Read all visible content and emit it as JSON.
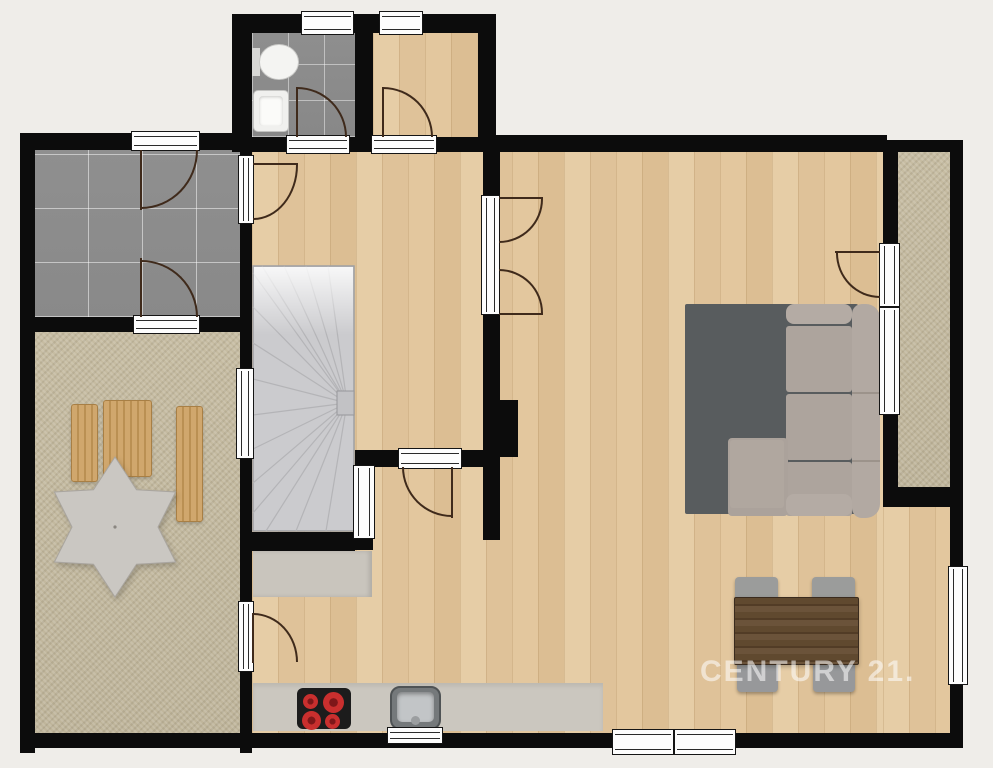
{
  "watermark": {
    "text": "CENTURY 21."
  },
  "canvas": {
    "width": 993,
    "height": 768,
    "background": "#efede9"
  },
  "palette": {
    "wall": "#0c0c0c",
    "wood_floor": "#e2c79f",
    "tile_floor": "#8e8e8e",
    "terrace_floor": "#c4ba9f",
    "stair": "#cbcbce",
    "rug": "#585c5e",
    "sofa": "#ada49d",
    "table_wood": "#5d4833",
    "counter": "#cbc7bf",
    "burner_red": "#c92f2e",
    "door_swing": "#3f2a1b",
    "window_white": "#fdfdfd",
    "watermark_white": "#ffffff"
  },
  "elements": [
    {
      "n": "living-area-floor",
      "c": "f-wood",
      "x": 252,
      "y": 150,
      "w": 631,
      "h": 583
    },
    {
      "n": "living-area-floor-east",
      "c": "f-wood",
      "x": 883,
      "y": 507,
      "w": 69,
      "h": 226
    },
    {
      "n": "small-room-floor",
      "c": "f-wood",
      "x": 373,
      "y": 33,
      "w": 105,
      "h": 104
    },
    {
      "n": "bathroom-floor",
      "c": "f-tile-sm",
      "x": 252,
      "y": 33,
      "w": 103,
      "h": 104
    },
    {
      "n": "entry-floor",
      "c": "f-tile-lg",
      "x": 34,
      "y": 150,
      "w": 206,
      "h": 167
    },
    {
      "n": "terrace-floor",
      "c": "f-terrace",
      "x": 35,
      "y": 332,
      "w": 205,
      "h": 408
    },
    {
      "n": "balcony-floor",
      "c": "f-terrace",
      "x": 898,
      "y": 150,
      "w": 52,
      "h": 337
    },
    {
      "n": "kitchen-cabinet",
      "x": 253,
      "y": 551,
      "w": 119,
      "h": 46,
      "bg": "#c9c5bd",
      "sh": "inset -3px 0 4px rgba(0,0,0,.12)"
    },
    {
      "n": "kitchen-counter",
      "x": 253,
      "y": 683,
      "w": 350,
      "h": 48,
      "bg": "#cbc7bf",
      "sh": "inset 0 3px 4px rgba(0,0,0,.08)"
    },
    {
      "n": "cooktop",
      "x": 297,
      "y": 688,
      "w": 54,
      "h": 41,
      "bg": "#1c1c1c",
      "br": "6px"
    },
    {
      "n": "burner",
      "c": "burner",
      "x": 303,
      "y": 694,
      "w": 15,
      "h": 15
    },
    {
      "n": "burner",
      "c": "burner",
      "x": 323,
      "y": 692,
      "w": 21,
      "h": 21
    },
    {
      "n": "burner",
      "c": "burner",
      "x": 302,
      "y": 711,
      "w": 19,
      "h": 19
    },
    {
      "n": "burner",
      "c": "burner",
      "x": 325,
      "y": 714,
      "w": 15,
      "h": 15
    },
    {
      "n": "kitchen-sink",
      "x": 390,
      "y": 686,
      "w": 51,
      "h": 44,
      "bg": "#75797b",
      "br": "10px",
      "bd": "2px solid #4f5355"
    },
    {
      "n": "kitchen-sink-basin",
      "x": 397,
      "y": 692,
      "w": 37,
      "h": 30,
      "bg": "#c2c5c7",
      "br": "5px",
      "sh": "inset 0 2px 4px rgba(0,0,0,.35)"
    },
    {
      "n": "kitchen-sink-faucet",
      "x": 411,
      "y": 716,
      "w": 9,
      "h": 9,
      "bg": "#9b9ea0",
      "br": "50%"
    },
    {
      "n": "rug",
      "x": 685,
      "y": 304,
      "w": 173,
      "h": 210,
      "bg": "#585c5e",
      "br": "2px"
    },
    {
      "n": "sofa-armrest-top",
      "x": 786,
      "y": 304,
      "w": 66,
      "h": 20,
      "bg": "#b4aba4",
      "br": "8px"
    },
    {
      "n": "sofa-seat",
      "x": 786,
      "y": 326,
      "w": 66,
      "h": 66,
      "bg": "#ada49d",
      "br": "3px"
    },
    {
      "n": "sofa-seat",
      "x": 786,
      "y": 394,
      "w": 66,
      "h": 66,
      "bg": "#ada49d",
      "br": "3px"
    },
    {
      "n": "sofa-seat",
      "x": 786,
      "y": 462,
      "w": 66,
      "h": 54,
      "bg": "#ada49d",
      "br": "3px"
    },
    {
      "n": "sofa-chaise",
      "x": 728,
      "y": 438,
      "w": 60,
      "h": 78,
      "bg": "#aba29b",
      "br": "4px"
    },
    {
      "n": "sofa-chaise-cushion",
      "x": 730,
      "y": 440,
      "w": 54,
      "h": 68,
      "bg": "#b0a79f",
      "br": "3px"
    },
    {
      "n": "sofa-armrest-front",
      "x": 786,
      "y": 494,
      "w": 66,
      "h": 22,
      "bg": "#b4aba4",
      "br": "8px"
    },
    {
      "n": "sofa-backrest",
      "x": 852,
      "y": 304,
      "w": 28,
      "h": 214,
      "bg": "#b2a9a2",
      "br": "10px 14px 14px 10px"
    },
    {
      "n": "sofa-divider",
      "x": 852,
      "y": 392,
      "w": 28,
      "h": 2,
      "bg": "#9c938b"
    },
    {
      "n": "sofa-divider",
      "x": 852,
      "y": 460,
      "w": 28,
      "h": 2,
      "bg": "#9c938b"
    },
    {
      "n": "dining-chair",
      "x": 735,
      "y": 577,
      "w": 43,
      "h": 26,
      "bg": "#9b9c9b",
      "br": "4px",
      "sh": "0 2px 3px rgba(0,0,0,.3)"
    },
    {
      "n": "dining-chair",
      "x": 812,
      "y": 577,
      "w": 43,
      "h": 26,
      "bg": "#9b9c9b",
      "br": "4px",
      "sh": "0 2px 3px rgba(0,0,0,.3)"
    },
    {
      "n": "dining-chair",
      "x": 737,
      "y": 660,
      "w": 41,
      "h": 32,
      "bg": "#97989a",
      "br": "4px",
      "sh": "0 2px 3px rgba(0,0,0,.3)"
    },
    {
      "n": "dining-chair",
      "x": 813,
      "y": 660,
      "w": 42,
      "h": 32,
      "bg": "#97989a",
      "br": "4px",
      "sh": "0 2px 3px rgba(0,0,0,.3)"
    },
    {
      "n": "dining-table",
      "c": "table-wood",
      "x": 734,
      "y": 597,
      "w": 125,
      "h": 68,
      "sh": "0 2px 4px rgba(0,0,0,.25)"
    },
    {
      "n": "deck-chair",
      "c": "chair-wood",
      "x": 71,
      "y": 404,
      "w": 27,
      "h": 78
    },
    {
      "n": "deck-chair",
      "c": "chair-wood",
      "x": 103,
      "y": 400,
      "w": 49,
      "h": 77
    },
    {
      "n": "deck-chair",
      "c": "chair-wood",
      "x": 176,
      "y": 406,
      "w": 27,
      "h": 116
    },
    {
      "n": "parasol",
      "t": "star",
      "x": 45,
      "y": 455,
      "w": 140,
      "h": 144,
      "star": {
        "r1": 70,
        "r2": 43,
        "tips": 6,
        "fill": "#cac7c2",
        "stroke": "#a9a59f"
      }
    },
    {
      "n": "staircase",
      "t": "stairs",
      "x": 252,
      "y": 265,
      "w": 103,
      "h": 267
    },
    {
      "n": "toilet-tank",
      "x": 252,
      "y": 48,
      "w": 8,
      "h": 28,
      "bg": "#d8d8d6"
    },
    {
      "n": "toilet-bowl",
      "x": 259,
      "y": 44,
      "w": 40,
      "h": 36,
      "bg": "#f4f4f2",
      "br": "50%",
      "bd": "1px solid #c9c9c7"
    },
    {
      "n": "bathroom-sink",
      "x": 253,
      "y": 90,
      "w": 36,
      "h": 42,
      "bg": "#f0f0ee",
      "br": "5px",
      "bd": "1px solid #c4c4c2"
    },
    {
      "n": "bathroom-sink-basin",
      "x": 259,
      "y": 96,
      "w": 24,
      "h": 30,
      "bg": "#fbfbf9",
      "br": "4px",
      "sh": "inset 0 1px 3px rgba(0,0,0,.2)"
    },
    {
      "n": "wall",
      "x": 232,
      "y": 14,
      "w": 264,
      "h": 19
    },
    {
      "n": "wall",
      "x": 232,
      "y": 14,
      "w": 20,
      "h": 138
    },
    {
      "n": "wall",
      "x": 478,
      "y": 14,
      "w": 18,
      "h": 138
    },
    {
      "n": "wall",
      "x": 355,
      "y": 33,
      "w": 18,
      "h": 119
    },
    {
      "n": "wall",
      "x": 252,
      "y": 137,
      "w": 36,
      "h": 15
    },
    {
      "n": "wall",
      "x": 348,
      "y": 137,
      "w": 7,
      "h": 15
    },
    {
      "n": "wall",
      "x": 435,
      "y": 137,
      "w": 43,
      "h": 15
    },
    {
      "n": "wall",
      "x": 478,
      "y": 135,
      "w": 409,
      "h": 17
    },
    {
      "n": "wall",
      "x": 883,
      "y": 140,
      "w": 80,
      "h": 12
    },
    {
      "n": "wall",
      "x": 20,
      "y": 133,
      "w": 113,
      "h": 17
    },
    {
      "n": "wall",
      "x": 198,
      "y": 133,
      "w": 34,
      "h": 17
    },
    {
      "n": "wall",
      "x": 20,
      "y": 133,
      "w": 15,
      "h": 620
    },
    {
      "n": "wall",
      "x": 20,
      "y": 317,
      "w": 115,
      "h": 15
    },
    {
      "n": "wall",
      "x": 198,
      "y": 317,
      "w": 42,
      "h": 15
    },
    {
      "n": "wall",
      "x": 240,
      "y": 133,
      "w": 12,
      "h": 24
    },
    {
      "n": "wall",
      "x": 240,
      "y": 222,
      "w": 12,
      "h": 148
    },
    {
      "n": "wall",
      "x": 240,
      "y": 457,
      "w": 12,
      "h": 146
    },
    {
      "n": "wall",
      "x": 240,
      "y": 670,
      "w": 12,
      "h": 83
    },
    {
      "n": "wall",
      "x": 20,
      "y": 733,
      "w": 592,
      "h": 15
    },
    {
      "n": "wall",
      "x": 736,
      "y": 733,
      "w": 227,
      "h": 15
    },
    {
      "n": "wall",
      "x": 950,
      "y": 140,
      "w": 13,
      "h": 428
    },
    {
      "n": "wall",
      "x": 950,
      "y": 683,
      "w": 13,
      "h": 65
    },
    {
      "n": "wall",
      "x": 883,
      "y": 150,
      "w": 15,
      "h": 95
    },
    {
      "n": "wall",
      "x": 883,
      "y": 413,
      "w": 15,
      "h": 94
    },
    {
      "n": "wall",
      "x": 883,
      "y": 487,
      "w": 80,
      "h": 20
    },
    {
      "n": "wall",
      "x": 483,
      "y": 152,
      "w": 17,
      "h": 45
    },
    {
      "n": "wall",
      "x": 483,
      "y": 313,
      "w": 17,
      "h": 87
    },
    {
      "n": "wall",
      "x": 483,
      "y": 400,
      "w": 35,
      "h": 57
    },
    {
      "n": "wall",
      "x": 483,
      "y": 457,
      "w": 17,
      "h": 83
    },
    {
      "n": "wall",
      "x": 355,
      "y": 450,
      "w": 45,
      "h": 17
    },
    {
      "n": "wall",
      "x": 460,
      "y": 450,
      "w": 27,
      "h": 17
    },
    {
      "n": "wall",
      "x": 355,
      "y": 537,
      "w": 18,
      "h": 13
    },
    {
      "n": "wall",
      "x": 240,
      "y": 532,
      "w": 115,
      "h": 19
    },
    {
      "n": "window",
      "t": "win",
      "o8": "h",
      "x": 301,
      "y": 11,
      "w": 53,
      "h": 24
    },
    {
      "n": "window",
      "t": "win",
      "o8": "h",
      "x": 379,
      "y": 11,
      "w": 44,
      "h": 24
    },
    {
      "n": "door-threshold",
      "t": "win",
      "o8": "h",
      "x": 131,
      "y": 131,
      "w": 69,
      "h": 20
    },
    {
      "n": "door-threshold",
      "t": "win",
      "o8": "h",
      "x": 133,
      "y": 315,
      "w": 67,
      "h": 19
    },
    {
      "n": "door-threshold",
      "t": "win",
      "o8": "v",
      "x": 238,
      "y": 155,
      "w": 16,
      "h": 69
    },
    {
      "n": "window",
      "t": "win",
      "o8": "v",
      "x": 236,
      "y": 368,
      "w": 18,
      "h": 91
    },
    {
      "n": "door-threshold",
      "t": "win",
      "o8": "v",
      "x": 238,
      "y": 601,
      "w": 16,
      "h": 71
    },
    {
      "n": "door-threshold",
      "t": "win",
      "o8": "h",
      "x": 286,
      "y": 135,
      "w": 64,
      "h": 19
    },
    {
      "n": "door-threshold",
      "t": "win",
      "o8": "h",
      "x": 371,
      "y": 135,
      "w": 66,
      "h": 19
    },
    {
      "n": "door-threshold",
      "t": "win",
      "o8": "v",
      "x": 481,
      "y": 195,
      "w": 19,
      "h": 120
    },
    {
      "n": "door-threshold",
      "t": "win",
      "o8": "h",
      "x": 398,
      "y": 448,
      "w": 64,
      "h": 21
    },
    {
      "n": "door-threshold",
      "t": "win",
      "o8": "v",
      "x": 353,
      "y": 465,
      "w": 22,
      "h": 74
    },
    {
      "n": "door-threshold",
      "t": "win",
      "o8": "v",
      "x": 879,
      "y": 243,
      "w": 21,
      "h": 64
    },
    {
      "n": "window",
      "t": "win",
      "o8": "v",
      "x": 879,
      "y": 307,
      "w": 21,
      "h": 108
    },
    {
      "n": "window",
      "t": "win",
      "o8": "v",
      "x": 948,
      "y": 566,
      "w": 20,
      "h": 119
    },
    {
      "n": "window",
      "t": "win",
      "o8": "h",
      "x": 612,
      "y": 729,
      "w": 62,
      "h": 26
    },
    {
      "n": "window",
      "t": "win",
      "o8": "h",
      "x": 674,
      "y": 729,
      "w": 62,
      "h": 26
    },
    {
      "n": "window",
      "t": "win",
      "o8": "h",
      "x": 387,
      "y": 727,
      "w": 56,
      "h": 17
    },
    {
      "n": "door-swing",
      "t": "arc",
      "k": "tl",
      "x": 141,
      "y": 150,
      "w": 57,
      "h": 59
    },
    {
      "n": "door-leaf",
      "x": 140,
      "y": 150,
      "w": 2,
      "h": 60,
      "bg": "#3f2a1b"
    },
    {
      "n": "door-swing",
      "t": "arc",
      "k": "bl",
      "x": 141,
      "y": 260,
      "w": 57,
      "h": 57
    },
    {
      "n": "door-leaf",
      "x": 140,
      "y": 258,
      "w": 2,
      "h": 59,
      "bg": "#3f2a1b"
    },
    {
      "n": "door-swing",
      "t": "arc",
      "k": "tl",
      "x": 253,
      "y": 165,
      "w": 45,
      "h": 55
    },
    {
      "n": "door-leaf",
      "x": 253,
      "y": 163,
      "w": 45,
      "h": 2,
      "bg": "#3f2a1b"
    },
    {
      "n": "door-swing",
      "t": "arc",
      "k": "bl",
      "x": 297,
      "y": 87,
      "w": 50,
      "h": 50
    },
    {
      "n": "door-leaf",
      "x": 296,
      "y": 87,
      "w": 2,
      "h": 50,
      "bg": "#3f2a1b"
    },
    {
      "n": "door-swing",
      "t": "arc",
      "k": "bl",
      "x": 383,
      "y": 87,
      "w": 50,
      "h": 50
    },
    {
      "n": "door-leaf",
      "x": 382,
      "y": 87,
      "w": 2,
      "h": 50,
      "bg": "#3f2a1b"
    },
    {
      "n": "door-swing",
      "t": "arc",
      "k": "tl",
      "x": 499,
      "y": 199,
      "w": 44,
      "h": 44
    },
    {
      "n": "door-leaf",
      "x": 499,
      "y": 197,
      "w": 44,
      "h": 2,
      "bg": "#3f2a1b"
    },
    {
      "n": "door-swing",
      "t": "arc",
      "k": "bl",
      "x": 499,
      "y": 269,
      "w": 44,
      "h": 44
    },
    {
      "n": "door-leaf",
      "x": 499,
      "y": 313,
      "w": 44,
      "h": 2,
      "bg": "#3f2a1b"
    },
    {
      "n": "door-swing",
      "t": "arc",
      "k": "tr",
      "x": 836,
      "y": 253,
      "w": 44,
      "h": 45
    },
    {
      "n": "door-leaf",
      "x": 835,
      "y": 251,
      "w": 45,
      "h": 2,
      "bg": "#3f2a1b"
    },
    {
      "n": "door-swing",
      "t": "arc",
      "k": "tr",
      "x": 402,
      "y": 467,
      "w": 50,
      "h": 50
    },
    {
      "n": "door-leaf",
      "x": 451,
      "y": 467,
      "w": 2,
      "h": 51,
      "bg": "#3f2a1b"
    },
    {
      "n": "door-swing",
      "t": "arc",
      "k": "bl",
      "x": 253,
      "y": 613,
      "w": 45,
      "h": 49
    },
    {
      "n": "door-leaf",
      "x": 252,
      "y": 613,
      "w": 2,
      "h": 50,
      "bg": "#3f2a1b"
    },
    {
      "n": "watermark",
      "t": "text",
      "x": 700,
      "y": 652,
      "w": 215,
      "h": 40,
      "bind": "watermark.text",
      "fs": 30,
      "fw": 700,
      "ls": 2,
      "col": "#ffffff",
      "o": 0.55
    }
  ]
}
